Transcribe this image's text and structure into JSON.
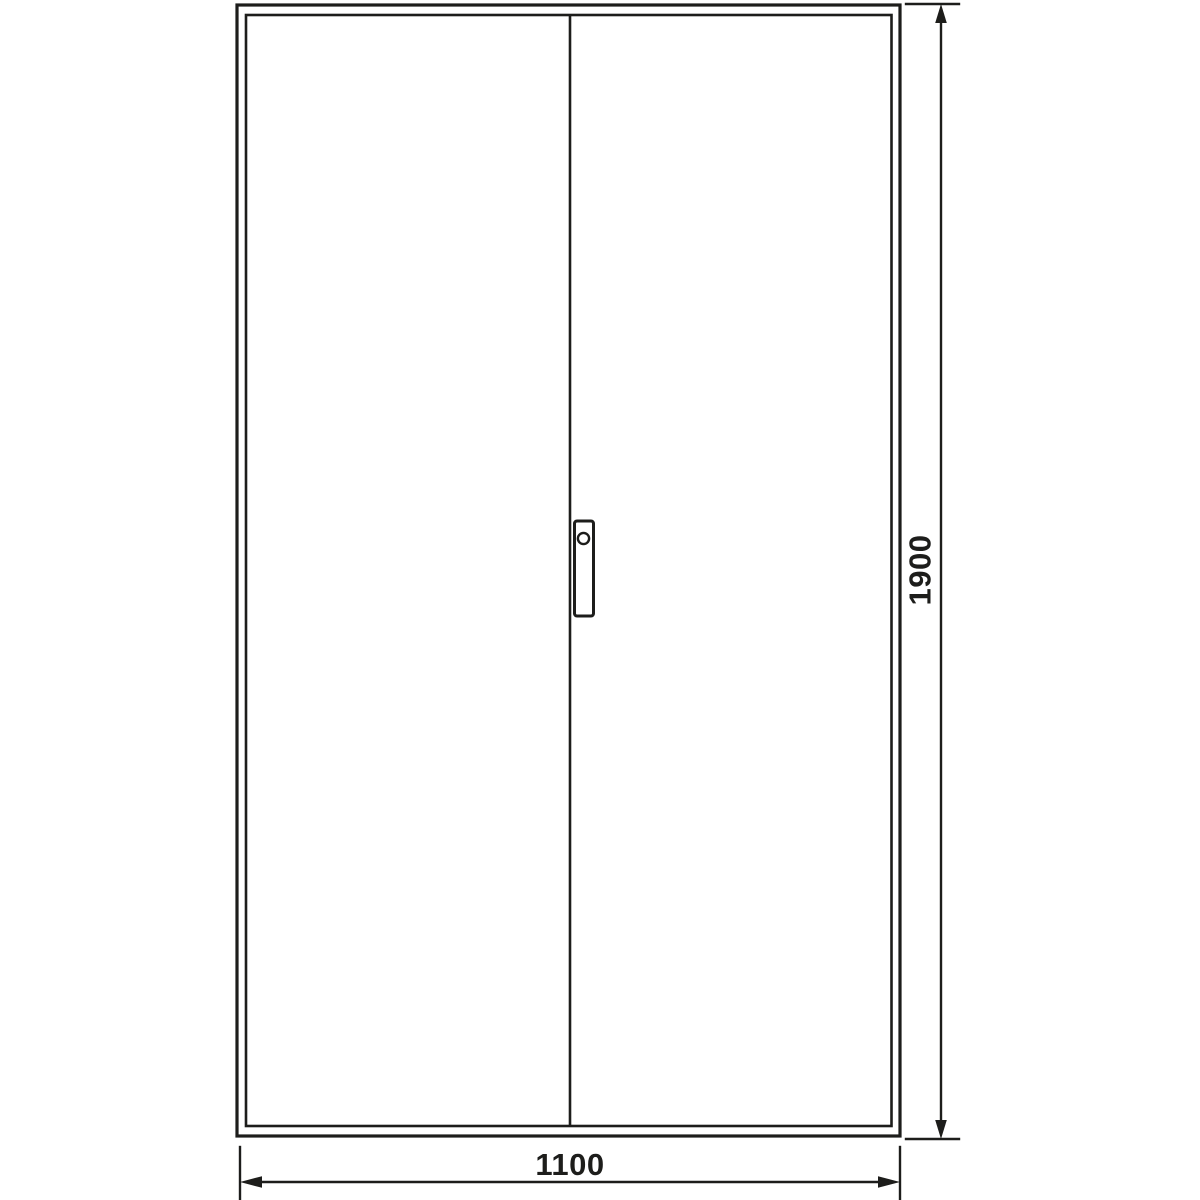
{
  "page": {
    "background_color": "#ffffff"
  },
  "colors": {
    "line": "#1d1d1b"
  },
  "drawing": {
    "type": "technical-front-view",
    "subject": "double-door enclosure / cabinet front elevation",
    "dimension_labels": {
      "height": "1900",
      "width": "1100"
    }
  }
}
